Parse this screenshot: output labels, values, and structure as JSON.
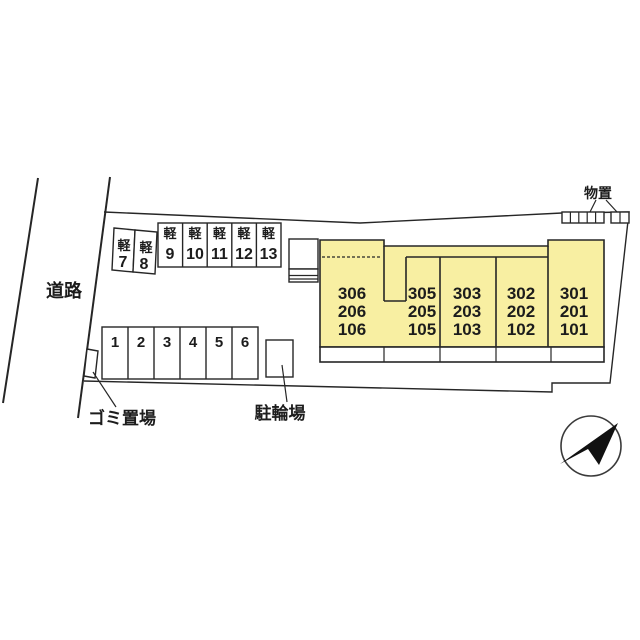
{
  "plan": {
    "road": {
      "label": "道路"
    },
    "garbage": {
      "label": "ゴミ置場"
    },
    "bicycle": {
      "label": "駐輪場"
    },
    "storage": {
      "label": "物置"
    },
    "kei": {
      "prefix": "軽",
      "numbers": [
        "7",
        "8",
        "9",
        "10",
        "11",
        "12",
        "13"
      ]
    },
    "parking": {
      "numbers": [
        "1",
        "2",
        "3",
        "4",
        "5",
        "6"
      ]
    },
    "building": {
      "units": [
        {
          "rooms": [
            "306",
            "206",
            "106"
          ]
        },
        {
          "rooms": [
            "305",
            "205",
            "105"
          ]
        },
        {
          "rooms": [
            "303",
            "203",
            "103"
          ]
        },
        {
          "rooms": [
            "302",
            "202",
            "102"
          ]
        },
        {
          "rooms": [
            "301",
            "201",
            "101"
          ]
        }
      ]
    },
    "colors": {
      "unit_fill": "#f8efa2",
      "line": "#262626"
    },
    "compass": {
      "icon": "north-arrow-upper-right"
    }
  }
}
